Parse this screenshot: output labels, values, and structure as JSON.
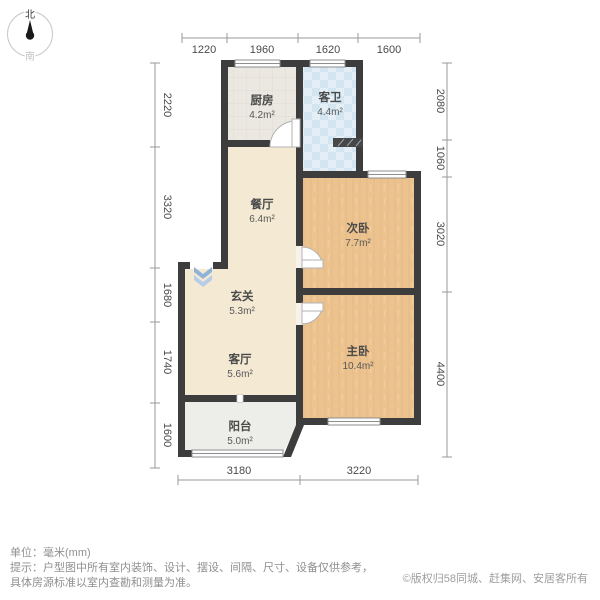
{
  "compass": {
    "north_label": "北",
    "south_label": "南"
  },
  "rooms": {
    "kitchen": {
      "name": "厨房",
      "area": "4.2m²"
    },
    "guest_bathroom": {
      "name": "客卫",
      "area": "4.4m²"
    },
    "dining_room": {
      "name": "餐厅",
      "area": "6.4m²"
    },
    "second_bedroom": {
      "name": "次卧",
      "area": "7.7m²"
    },
    "entry_hall": {
      "name": "玄关",
      "area": "5.3m²"
    },
    "living_room": {
      "name": "客厅",
      "area": "5.6m²"
    },
    "master_bedroom": {
      "name": "主卧",
      "area": "10.4m²"
    },
    "balcony": {
      "name": "阳台",
      "area": "5.0m²"
    }
  },
  "dimensions_mm": {
    "top": [
      "1220",
      "1960",
      "1620",
      "1600"
    ],
    "left": [
      "2220",
      "3320",
      "1680",
      "1740",
      "1600"
    ],
    "right": [
      "2080",
      "1060",
      "3020",
      "4400"
    ],
    "bottom": [
      "3180",
      "3220"
    ]
  },
  "footer": {
    "unit_line": "单位：毫米(mm)",
    "tip_line1": "提示：户型图中所有室内装饰、设计、摆设、间隔、尺寸、设备仅供参考，",
    "tip_line2": "具体房源标准以室内查勘和测量为准。",
    "copyright": "©版权归58同城、赶集网、安居客所有"
  },
  "icons": {
    "compass_needle": "teardrop-north-pointer",
    "entry_arrow": "double-chevron-down"
  },
  "colors": {
    "wall": "#3d3d3d",
    "wood_floor": "#ecc28f",
    "bathroom_tile": "#dfedf6",
    "warm_floor": "#f4e9d3",
    "kitchen_floor": "#ebe7e1",
    "balcony_floor": "#edeeea",
    "entry_arrow_blue": "#8fb2d8",
    "dimension_text": "#4a4a4a"
  }
}
